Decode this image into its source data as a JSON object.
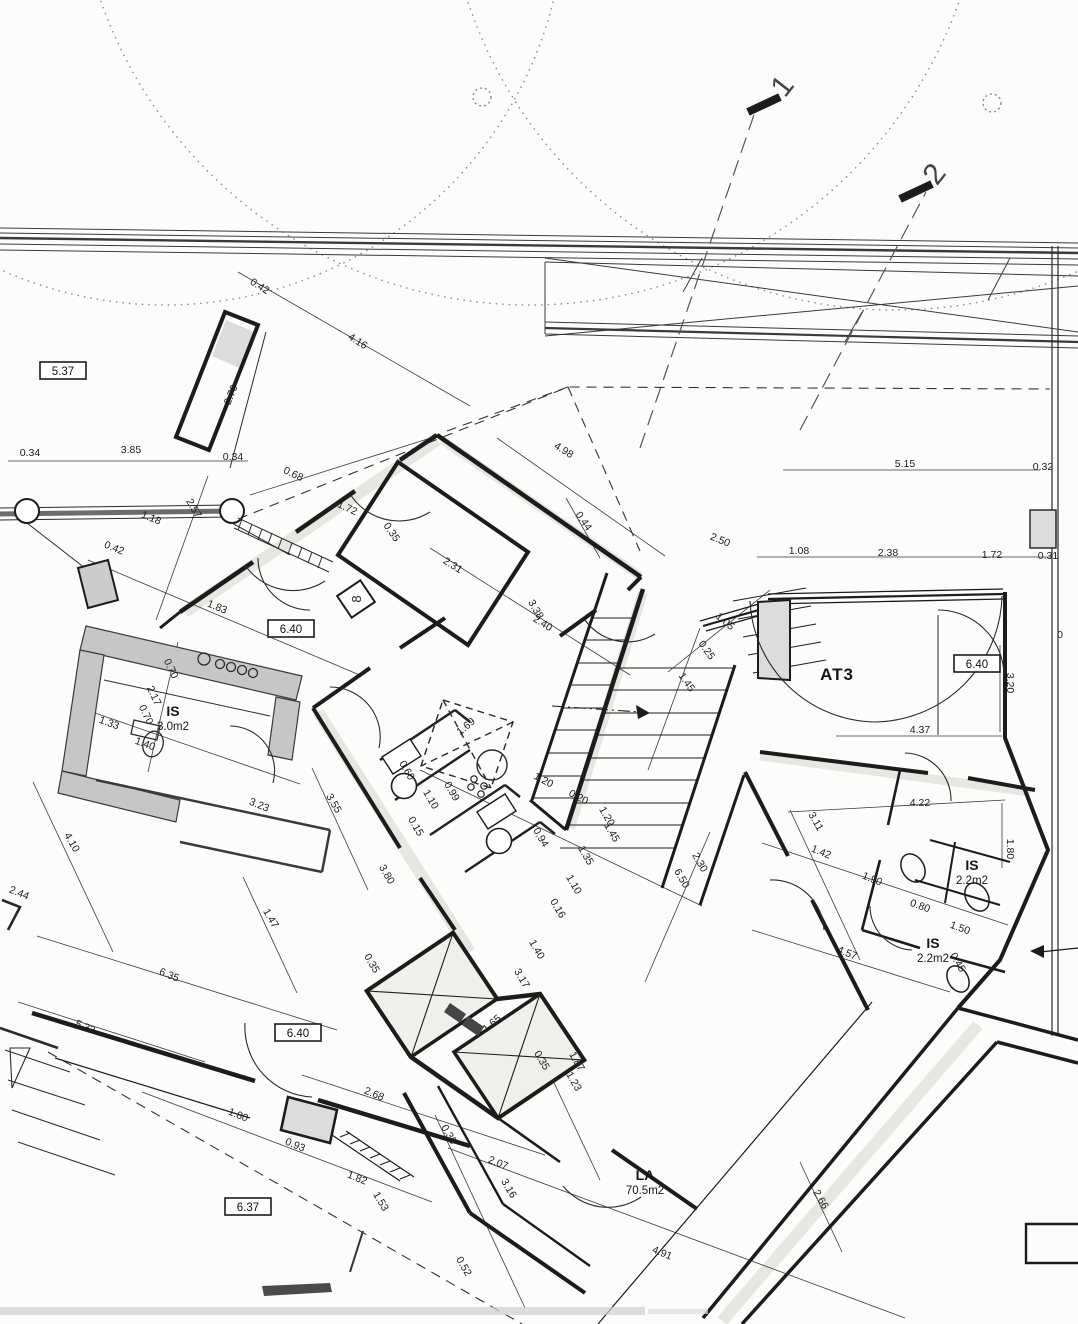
{
  "colors": {
    "paper": "#fcfcfa",
    "ink": "#1c1c1c",
    "grey_fill": "#d8d8d6"
  },
  "section_markers": [
    {
      "label": "1"
    },
    {
      "label": "2"
    }
  ],
  "level_boxes": [
    {
      "text": "5.37",
      "x": 63,
      "y": 371
    },
    {
      "text": "6.40",
      "x": 291,
      "y": 629
    },
    {
      "text": "6.40",
      "x": 977,
      "y": 664
    },
    {
      "text": "6.40",
      "x": 298,
      "y": 1033
    },
    {
      "text": "6.37",
      "x": 248,
      "y": 1207
    }
  ],
  "rooms": [
    {
      "name": "IS",
      "area": "3.0m2"
    },
    {
      "name": "AT3",
      "area": ""
    },
    {
      "name": "IS",
      "area": "2.2m2"
    },
    {
      "name": "IS",
      "area": "2.2m2"
    },
    {
      "name": "LA",
      "area": "70.5m2"
    }
  ],
  "door_tag": "8",
  "dimensions": [
    {
      "t": "0.42",
      "x": 258,
      "y": 289,
      "r": 32
    },
    {
      "t": "4.16",
      "x": 356,
      "y": 344,
      "r": 32
    },
    {
      "t": "2.70",
      "x": 234,
      "y": 396,
      "r": -68
    },
    {
      "t": "0.34",
      "x": 30,
      "y": 456,
      "r": 0
    },
    {
      "t": "3.85",
      "x": 131,
      "y": 453,
      "r": 0
    },
    {
      "t": "0.34",
      "x": 233,
      "y": 460,
      "r": 0
    },
    {
      "t": "0.68",
      "x": 292,
      "y": 477,
      "r": 25
    },
    {
      "t": "1.72",
      "x": 346,
      "y": 511,
      "r": 25
    },
    {
      "t": "0.35",
      "x": 389,
      "y": 534,
      "r": 55
    },
    {
      "t": "1.18",
      "x": 150,
      "y": 521,
      "r": 22
    },
    {
      "t": "2.57",
      "x": 191,
      "y": 510,
      "r": 60
    },
    {
      "t": "0.42",
      "x": 113,
      "y": 551,
      "r": 22
    },
    {
      "t": "1.83",
      "x": 216,
      "y": 610,
      "r": 22
    },
    {
      "t": "5.15",
      "x": 905,
      "y": 467,
      "r": 0
    },
    {
      "t": "0.32",
      "x": 1043,
      "y": 470,
      "r": 0
    },
    {
      "t": "2.50",
      "x": 719,
      "y": 543,
      "r": 22
    },
    {
      "t": "1.08",
      "x": 799,
      "y": 554,
      "r": 0
    },
    {
      "t": "2.38",
      "x": 888,
      "y": 556,
      "r": 0
    },
    {
      "t": "1.72",
      "x": 992,
      "y": 558,
      "r": 0
    },
    {
      "t": "0.31",
      "x": 1048,
      "y": 559,
      "r": 0
    },
    {
      "t": "0",
      "x": 1060,
      "y": 638,
      "r": 0
    },
    {
      "t": "4.98",
      "x": 562,
      "y": 453,
      "r": 32
    },
    {
      "t": "0.44",
      "x": 581,
      "y": 523,
      "r": 55
    },
    {
      "t": "2.31",
      "x": 451,
      "y": 568,
      "r": 32
    },
    {
      "t": "3.38",
      "x": 533,
      "y": 611,
      "r": 60
    },
    {
      "t": "2.40",
      "x": 541,
      "y": 626,
      "r": 32
    },
    {
      "t": "1.05",
      "x": 723,
      "y": 624,
      "r": 40
    },
    {
      "t": "0.25",
      "x": 704,
      "y": 652,
      "r": 55
    },
    {
      "t": "1.45",
      "x": 684,
      "y": 684,
      "r": 55
    },
    {
      "t": "1.69",
      "x": 468,
      "y": 729,
      "r": -40
    },
    {
      "t": "0.60",
      "x": 404,
      "y": 772,
      "r": 60
    },
    {
      "t": "0.99",
      "x": 449,
      "y": 793,
      "r": 60
    },
    {
      "t": "1.10",
      "x": 428,
      "y": 801,
      "r": 60
    },
    {
      "t": "0.15",
      "x": 413,
      "y": 828,
      "r": 60
    },
    {
      "t": "1.20",
      "x": 542,
      "y": 783,
      "r": 28
    },
    {
      "t": "0.20",
      "x": 577,
      "y": 800,
      "r": 28
    },
    {
      "t": "1.20",
      "x": 604,
      "y": 818,
      "r": 60
    },
    {
      "t": "1.45",
      "x": 609,
      "y": 834,
      "r": 60
    },
    {
      "t": "0.94",
      "x": 538,
      "y": 839,
      "r": 60
    },
    {
      "t": "1.35",
      "x": 583,
      "y": 857,
      "r": 60
    },
    {
      "t": "1.10",
      "x": 571,
      "y": 886,
      "r": 60
    },
    {
      "t": "0.16",
      "x": 555,
      "y": 910,
      "r": 60
    },
    {
      "t": "6.50",
      "x": 679,
      "y": 880,
      "r": 60
    },
    {
      "t": "2.30",
      "x": 697,
      "y": 864,
      "r": 60
    },
    {
      "t": "3.80",
      "x": 384,
      "y": 876,
      "r": 60
    },
    {
      "t": "0.35",
      "x": 369,
      "y": 965,
      "r": 60
    },
    {
      "t": "3.55",
      "x": 331,
      "y": 805,
      "r": 60
    },
    {
      "t": "3.23",
      "x": 258,
      "y": 808,
      "r": 22
    },
    {
      "t": "4.10",
      "x": 69,
      "y": 844,
      "r": 60
    },
    {
      "t": "2.44",
      "x": 18,
      "y": 896,
      "r": 22
    },
    {
      "t": "1.47",
      "x": 268,
      "y": 920,
      "r": 60
    },
    {
      "t": "6.35",
      "x": 168,
      "y": 978,
      "r": 22
    },
    {
      "t": "5.32",
      "x": 84,
      "y": 1030,
      "r": 22
    },
    {
      "t": "1.40",
      "x": 534,
      "y": 951,
      "r": 60
    },
    {
      "t": "3.17",
      "x": 519,
      "y": 980,
      "r": 60
    },
    {
      "t": "4.37",
      "x": 920,
      "y": 733,
      "r": 0
    },
    {
      "t": "3.20",
      "x": 1007,
      "y": 683,
      "r": 90
    },
    {
      "t": "4.22",
      "x": 920,
      "y": 806,
      "r": 0
    },
    {
      "t": "1.80",
      "x": 1007,
      "y": 849,
      "r": 90
    },
    {
      "t": "3.11",
      "x": 813,
      "y": 823,
      "r": 60
    },
    {
      "t": "1.42",
      "x": 820,
      "y": 855,
      "r": 22
    },
    {
      "t": "1.90",
      "x": 871,
      "y": 882,
      "r": 22
    },
    {
      "t": "0.80",
      "x": 919,
      "y": 909,
      "r": 20
    },
    {
      "t": "1.50",
      "x": 959,
      "y": 931,
      "r": 20
    },
    {
      "t": "0.45",
      "x": 955,
      "y": 964,
      "r": 60
    },
    {
      "t": "4.57",
      "x": 846,
      "y": 956,
      "r": 22
    },
    {
      "t": "2.66",
      "x": 818,
      "y": 1201,
      "r": 60
    },
    {
      "t": "1.65",
      "x": 494,
      "y": 1026,
      "r": -40
    },
    {
      "t": "0.35",
      "x": 539,
      "y": 1062,
      "r": 60
    },
    {
      "t": "1.87",
      "x": 574,
      "y": 1063,
      "r": 60
    },
    {
      "t": "1.23",
      "x": 571,
      "y": 1083,
      "r": 60
    },
    {
      "t": "2.68",
      "x": 373,
      "y": 1097,
      "r": 22
    },
    {
      "t": "1.80",
      "x": 237,
      "y": 1118,
      "r": 22
    },
    {
      "t": "0.93",
      "x": 294,
      "y": 1148,
      "r": 22
    },
    {
      "t": "1.82",
      "x": 356,
      "y": 1181,
      "r": 22
    },
    {
      "t": "1.53",
      "x": 378,
      "y": 1203,
      "r": 60
    },
    {
      "t": "0.35",
      "x": 446,
      "y": 1136,
      "r": 60
    },
    {
      "t": "2.07",
      "x": 497,
      "y": 1166,
      "r": 22
    },
    {
      "t": "3.16",
      "x": 506,
      "y": 1190,
      "r": 60
    },
    {
      "t": "0.52",
      "x": 461,
      "y": 1268,
      "r": 60
    },
    {
      "t": "4.91",
      "x": 661,
      "y": 1256,
      "r": 22
    },
    {
      "t": "2.17",
      "x": 151,
      "y": 697,
      "r": 65
    },
    {
      "t": "0.70",
      "x": 168,
      "y": 670,
      "r": 65
    },
    {
      "t": "0.70",
      "x": 143,
      "y": 716,
      "r": 65
    },
    {
      "t": "1.40",
      "x": 144,
      "y": 747,
      "r": 20
    },
    {
      "t": "1.33",
      "x": 108,
      "y": 726,
      "r": 20
    }
  ]
}
